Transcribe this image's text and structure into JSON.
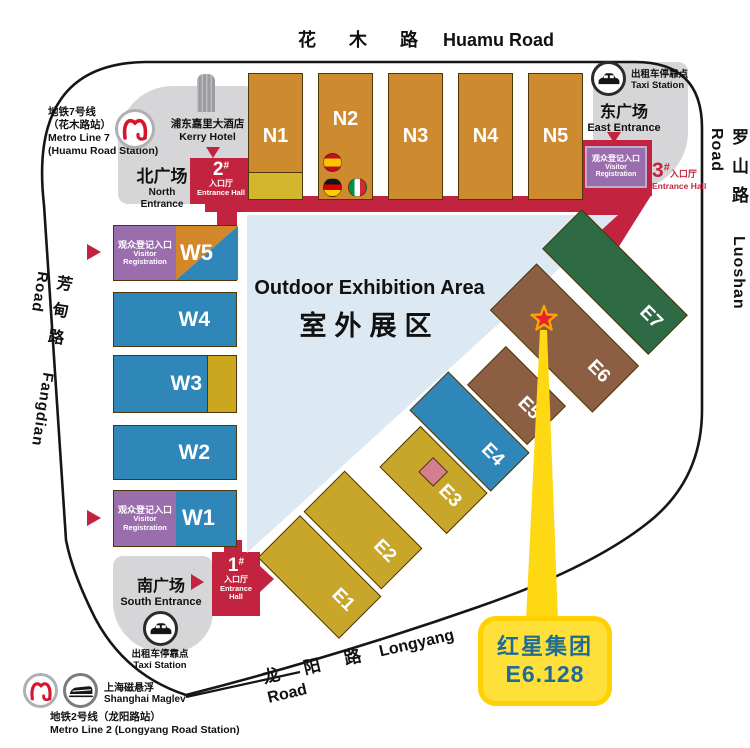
{
  "roads": {
    "huamu": {
      "zh": "花 木 路",
      "en": "Huamu Road"
    },
    "luoshan": {
      "zh": "罗山路",
      "en": "Luoshan Road"
    },
    "fangdian": {
      "zh": "芳甸路",
      "en": "Fangdian Road"
    },
    "longyang": {
      "zh": "龙 阳 路",
      "en": "Longyang Road"
    }
  },
  "transit": {
    "metro7_line1": "地铁7号线",
    "metro7_line2": "（花木路站）",
    "metro7_line3": "Metro Line 7",
    "metro7_line4": "(Huamu Road Station)",
    "metro2_zh": "地铁2号线（龙阳路站）",
    "metro2_en": "Metro Line 2 (Longyang Road Station)",
    "maglev_zh": "上海磁悬浮",
    "maglev_en": "Shanghai Maglev",
    "taxi_zh": "出租车停靠点",
    "taxi_en": "Taxi Station",
    "kerry_zh": "浦东嘉里大酒店",
    "kerry_en": "Kerry Hotel"
  },
  "entrances": {
    "north_zh": "北广场",
    "north_en1": "North",
    "north_en2": "Entrance",
    "east_zh": "东广场",
    "east_en": "East Entrance",
    "south_zh": "南广场",
    "south_en": "South Entrance",
    "hall1_num": "1",
    "hall1_sup": "#",
    "hall1_zh": "入口厅",
    "hall1_en": "Entrance Hall",
    "hall2_num": "2",
    "hall2_sup": "#",
    "hall2_zh": "入口厅",
    "hall2_en": "Entrance Hall",
    "hall3_num": "3",
    "hall3_sup": "#",
    "hall3_zh": "入口厅",
    "hall3_en": "Entrance Hall"
  },
  "visitor_registration": {
    "zh": "观众登记入口",
    "en1": "Visitor",
    "en2": "Registration"
  },
  "outdoor_area": {
    "en": "Outdoor Exhibition Area",
    "zh": "室外展区"
  },
  "halls": {
    "north": [
      "N1",
      "N2",
      "N3",
      "N4",
      "N5"
    ],
    "west": [
      "W1",
      "W2",
      "W3",
      "W4",
      "W5"
    ],
    "east": [
      "E1",
      "E2",
      "E3",
      "E4",
      "E5",
      "E6",
      "E7"
    ]
  },
  "callout": {
    "company": "红星集团",
    "booth": "E6.128"
  },
  "colors": {
    "hall_orange": "#ce8a2e",
    "hall_blue": "#2f86b8",
    "hall_gold": "#c8a62a",
    "hall_brown": "#8d5f42",
    "hall_green": "#2e6b44",
    "hall_yellow_section": "#d4b62c",
    "entrance_red": "#c2243f",
    "registration_purple": "#9a6eac",
    "outdoor_light_blue": "#dce9f2",
    "plaza_gray": "#d6d6d8",
    "callout_yellow": "#ffd814",
    "callout_text_teal": "#1d6b96",
    "star_red": "#e8232e",
    "star_outline_orange": "#f6a800",
    "pink_section": "#d47e90"
  }
}
